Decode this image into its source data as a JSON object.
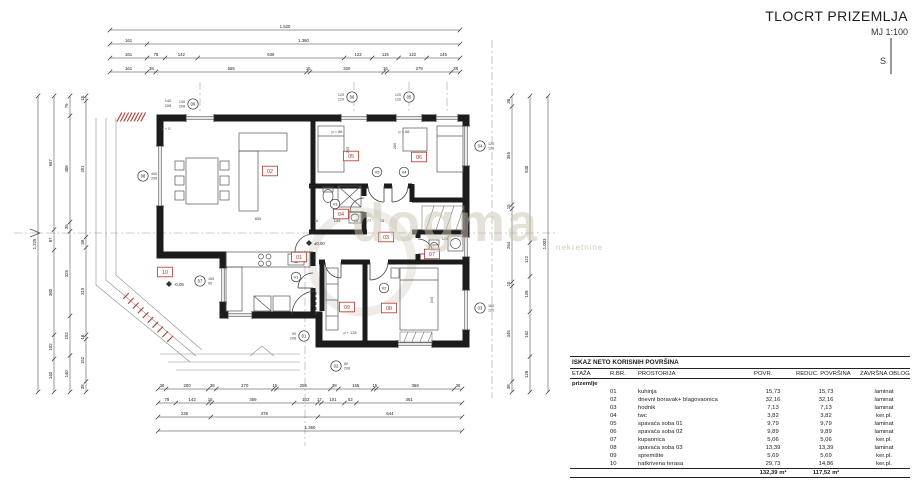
{
  "title": {
    "main": "TLOCRT PRIZEMLJA",
    "scale": "MJ 1:100",
    "north_label": "S"
  },
  "watermark": {
    "text": "dogma",
    "subtext": "nekretnine"
  },
  "plan": {
    "parapet_texts": [
      "p = 88",
      "p = 88",
      "p + 128",
      "p + 0"
    ],
    "elevation_texts": [
      "±0,00",
      "-0,05"
    ],
    "interior_dim_texts": [
      "655",
      "16",
      "143",
      "15",
      "77",
      "15",
      "205",
      "280",
      "345",
      "140",
      "208",
      "126"
    ],
    "door_marks": [
      "V1",
      "V2",
      "V3",
      "V4",
      "V5"
    ],
    "opening_marks": [
      {
        "num": "08",
        "size": "400/208"
      },
      {
        "num": "09",
        "size": "140/208"
      },
      {
        "num": "06",
        "size": "120/120"
      },
      {
        "num": "05",
        "size": "120/120"
      },
      {
        "num": "04",
        "size": "120/120"
      },
      {
        "num": "03",
        "size": "180/120"
      },
      {
        "num": "01",
        "size": "90/208"
      },
      {
        "num": "02",
        "size": "80/208"
      },
      {
        "num": "07",
        "size": "150/90"
      }
    ]
  },
  "dimensions": {
    "top": [
      [
        "1.520"
      ],
      [
        "161",
        "1.360"
      ],
      [
        "161",
        "78",
        "142",
        "636",
        "122",
        "115",
        "122",
        "145"
      ],
      [
        "161",
        "38",
        "655",
        "15",
        "320",
        "15",
        "279",
        "38"
      ]
    ],
    "bottom": [
      [
        "38",
        "200",
        "38",
        "270",
        "15",
        "255",
        "38",
        "165",
        "15",
        "368",
        "38"
      ],
      [
        "78",
        "142",
        "15",
        "359",
        "102",
        "17",
        "101",
        "52",
        "461"
      ],
      [
        "236",
        "478",
        "644"
      ],
      [
        "1.360"
      ]
    ],
    "left": [
      [
        "1.225"
      ],
      [
        "567",
        "87",
        "360",
        "102",
        "140"
      ],
      [
        "76",
        "408",
        "36",
        "325",
        "152",
        "140"
      ],
      [
        "18",
        "491",
        "38",
        "315",
        "16",
        "152",
        "38"
      ]
    ],
    "right": [
      [
        "38",
        "355",
        "15",
        "264",
        "15",
        "345",
        "38"
      ],
      [
        "530",
        "122",
        "128",
        "162",
        "128"
      ],
      [
        "1.003"
      ]
    ]
  },
  "table": {
    "title": "ISKAZ NETO KORISNIH POVRŠINA",
    "columns": [
      "ETAŽA",
      "R.BR.",
      "PROSTORIJA",
      "POVR.",
      "REDUC. POVRŠINA",
      "ZAVRŠNA OBLOGA"
    ],
    "group": "prizemlje",
    "rows": [
      {
        "rbr": "01",
        "name": "kuhinja",
        "povr": "15,73",
        "reduc": "15,73",
        "obloga": "laminat"
      },
      {
        "rbr": "02",
        "name": "dnevni boravak+ blagovaonica",
        "povr": "32,16",
        "reduc": "32,16",
        "obloga": "laminat"
      },
      {
        "rbr": "03",
        "name": "hodnik",
        "povr": "7,13",
        "reduc": "7,13",
        "obloga": "laminat"
      },
      {
        "rbr": "04",
        "name": "twc",
        "povr": "3,82",
        "reduc": "3,82",
        "obloga": "ker.pl."
      },
      {
        "rbr": "05",
        "name": "spavaća soba 01",
        "povr": "9,79",
        "reduc": "9,79",
        "obloga": "laminat"
      },
      {
        "rbr": "06",
        "name": "spavaća soba 02",
        "povr": "9,89",
        "reduc": "9,89",
        "obloga": "laminat"
      },
      {
        "rbr": "07",
        "name": "kupaonica",
        "povr": "5,06",
        "reduc": "5,06",
        "obloga": "ker.pl."
      },
      {
        "rbr": "08",
        "name": "spavaća soba 03",
        "povr": "13,39",
        "reduc": "13,39",
        "obloga": "laminat"
      },
      {
        "rbr": "09",
        "name": "spremište",
        "povr": "5,69",
        "reduc": "5,69",
        "obloga": "ker.pl."
      },
      {
        "rbr": "10",
        "name": "natkrivena terasa",
        "povr": "29,73",
        "reduc": "14,86",
        "obloga": "ker.pl."
      }
    ],
    "totals": {
      "povr": "132,39 m²",
      "reduc": "117,52 m²"
    }
  }
}
